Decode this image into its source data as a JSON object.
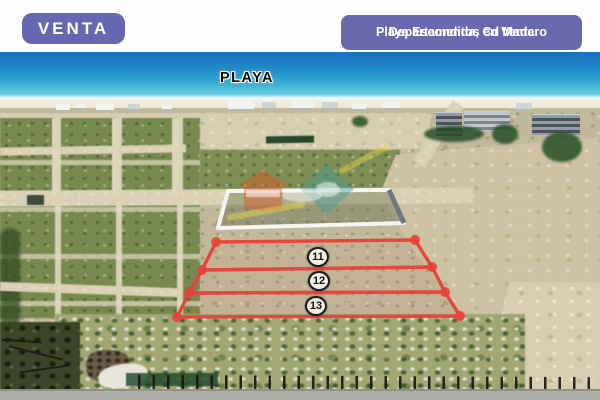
{
  "badges": {
    "venta_label": "VENTA",
    "listing_title_line1": "Departamentos en Venta",
    "listing_title_line2": "Playa Escondida, Cd Madero"
  },
  "photo_labels": {
    "beach_label": "PLAYA"
  },
  "plot_markers": [
    {
      "number": "11"
    },
    {
      "number": "12"
    },
    {
      "number": "13"
    }
  ],
  "colors": {
    "badge_background": "#6568b0",
    "badge_text": "#ffffff",
    "plot_outline_red": "#e9403a",
    "walled_plot_outline": "#f4f4f2",
    "marker_fill": "#f0efe4",
    "marker_border": "#1b1b1b",
    "ocean_deep": "#1a6fbe",
    "ocean_shallow": "#8adce6",
    "beach_sand": "#f3eedf",
    "field_green": "#78894f",
    "dirt_tan": "#c2b89c",
    "playa_label_text": "#0b0b0b"
  }
}
